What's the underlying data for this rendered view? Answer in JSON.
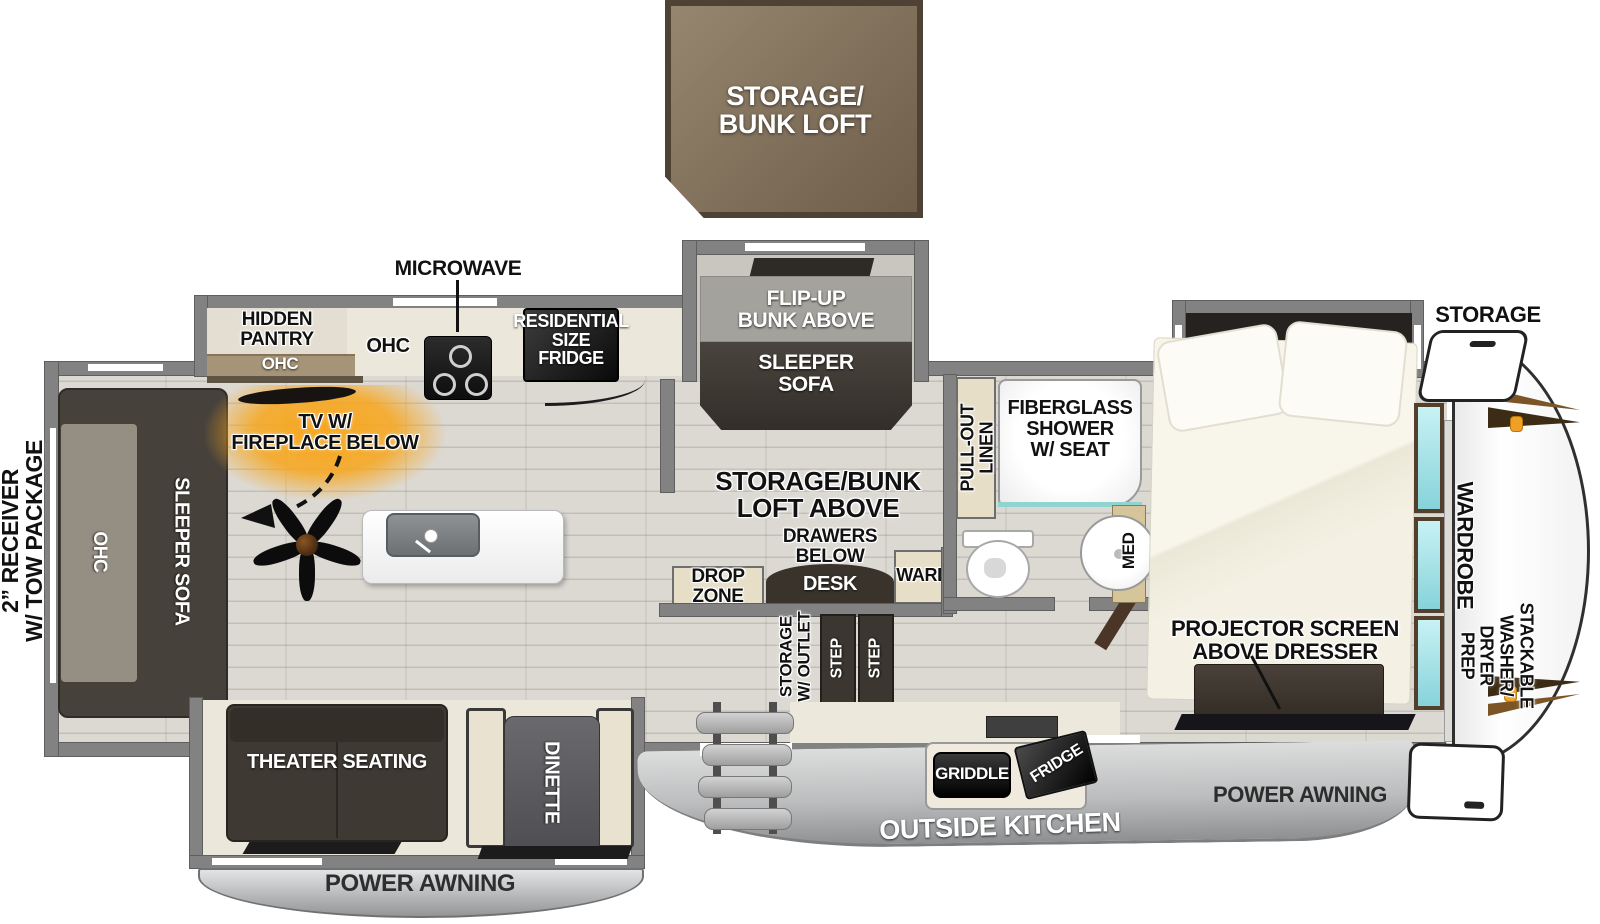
{
  "loft_box": {
    "label": "STORAGE/\nBUNK LOFT"
  },
  "exterior": {
    "receiver": "2” RECEIVER\nW/ TOW PACKAGE",
    "awning_left": "POWER AWNING",
    "awning_right": "POWER AWNING",
    "outside_kitchen": "OUTSIDE KITCHEN",
    "griddle": "GRIDDLE",
    "fridge": "FRIDGE",
    "storage_front": "STORAGE"
  },
  "kitchen": {
    "microwave": "MICROWAVE",
    "hidden_pantry": "HIDDEN\nPANTRY",
    "pantry_ohc": "OHC",
    "counter_ohc": "OHC",
    "residential_fridge": "RESIDENTIAL\nSIZE\nFRIDGE",
    "tv_fireplace": "TV W/\nFIREPLACE BELOW"
  },
  "living": {
    "loft_above": "STORAGE/BUNK\nLOFT ABOVE",
    "rear_sofa": "SLEEPER SOFA",
    "rear_ohc": "OHC",
    "theater": "THEATER SEATING",
    "dinette": "DINETTE"
  },
  "bunk_slide": {
    "flip_up_bunk": "FLIP-UP\nBUNK ABOVE",
    "sleeper_sofa": "SLEEPER\nSOFA"
  },
  "desk_area": {
    "drawers_below": "DRAWERS\nBELOW",
    "desk": "DESK",
    "ward": "WARD",
    "drop_zone": "DROP\nZONE",
    "storage_outlet": "STORAGE\nW/ OUTLET",
    "step_1": "STEP",
    "step_2": "STEP"
  },
  "bath": {
    "pull_out_linen": "PULL-OUT\nLINEN",
    "shower": "FIBERGLASS\nSHOWER\nW/ SEAT",
    "med": "MED"
  },
  "bedroom": {
    "projector": "PROJECTOR SCREEN\nABOVE DRESSER",
    "wardrobe": "WARDROBE",
    "stackable": "STACKABLE\nWASHER/\nDRYER\nPREP"
  },
  "colors": {
    "loft_brown": "#7c6b55",
    "wall_gray": "#828282",
    "fireplace_glow": "#f7a61d",
    "mirror_teal": "#9fe0e5",
    "awning_gray": "#9b9d9f",
    "cap_accent_brown": "#7c5526"
  }
}
